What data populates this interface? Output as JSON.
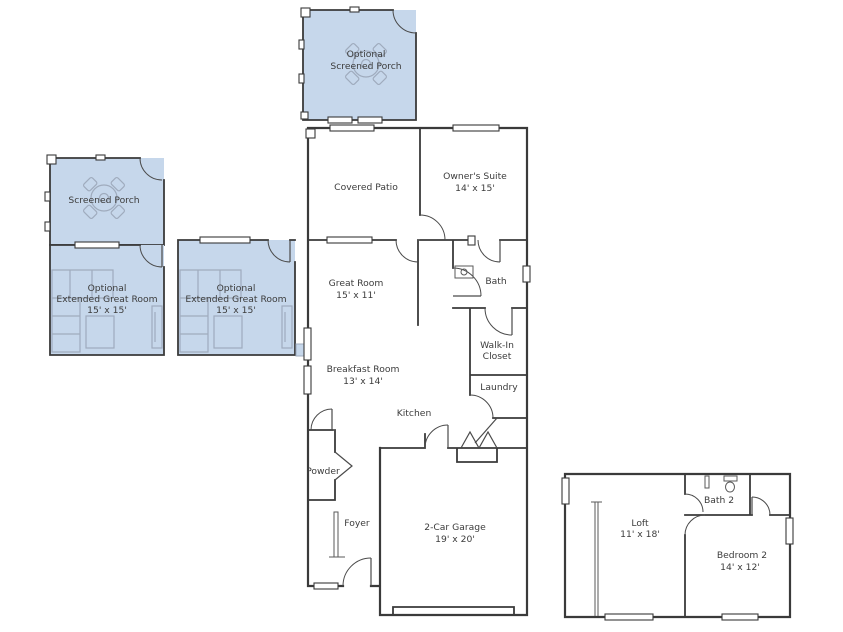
{
  "floor_plan": {
    "highlight_color": "#c6d7eb",
    "wall_color": "#3a3a3a",
    "text_color": "#3c3c3c",
    "rooms": {
      "optional_screened_porch": {
        "line1": "Optional",
        "line2": "Screened Porch"
      },
      "screened_porch": {
        "line1": "Screened Porch"
      },
      "optional_extended_great_room_left": {
        "line1": "Optional",
        "line2": "Extended Great Room",
        "line3": "15' x 15'"
      },
      "optional_extended_great_room_center": {
        "line1": "Optional",
        "line2": "Extended Great Room",
        "line3": "15' x 15'"
      },
      "covered_patio": {
        "line1": "Covered Patio"
      },
      "owners_suite": {
        "line1": "Owner's Suite",
        "line2": "14' x 15'"
      },
      "great_room": {
        "line1": "Great Room",
        "line2": "15' x 11'"
      },
      "bath": {
        "line1": "Bath"
      },
      "walk_in_closet": {
        "line1": "Walk-In",
        "line2": "Closet"
      },
      "laundry": {
        "line1": "Laundry"
      },
      "breakfast_room": {
        "line1": "Breakfast Room",
        "line2": "13' x 14'"
      },
      "kitchen": {
        "line1": "Kitchen"
      },
      "powder": {
        "line1": "Powder"
      },
      "foyer": {
        "line1": "Foyer"
      },
      "garage": {
        "line1": "2-Car Garage",
        "line2": "19' x 20'"
      },
      "loft": {
        "line1": "Loft",
        "line2": "11' x 18'"
      },
      "bath_2": {
        "line1": "Bath 2"
      },
      "bedroom_2": {
        "line1": "Bedroom 2",
        "line2": "14' x 12'"
      }
    }
  }
}
